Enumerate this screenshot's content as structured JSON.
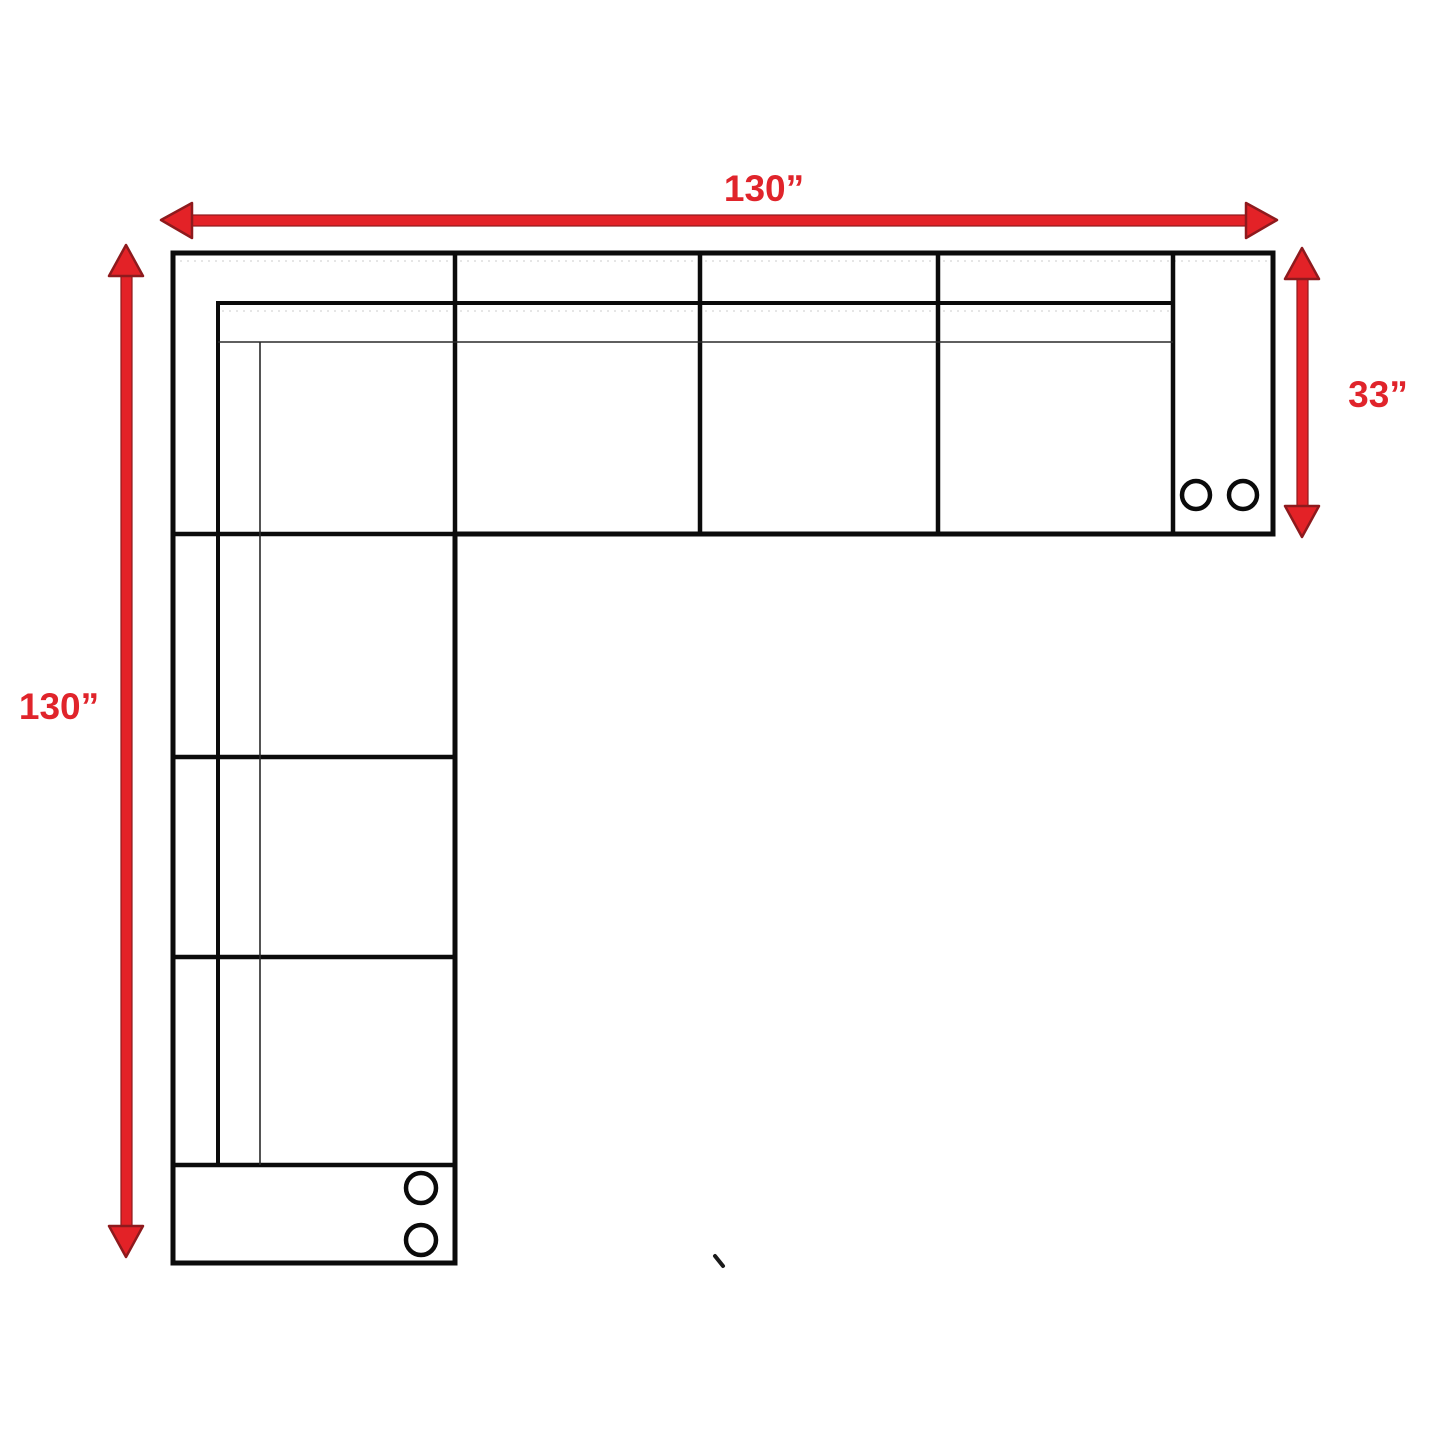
{
  "page": {
    "background": "#ffffff",
    "kind": "sectional-sofa-dimension-diagram"
  },
  "diagram": {
    "dimensions": {
      "top_width": {
        "label": "130”",
        "orientation": "horizontal",
        "edge": "top"
      },
      "left_height": {
        "label": "130”",
        "orientation": "vertical",
        "edge": "left"
      },
      "right_depth": {
        "label": "33”",
        "orientation": "vertical",
        "edge": "right"
      }
    },
    "colors": {
      "dimension_red": "#e32227",
      "arrowhead_dark_red": "#8e1a1d",
      "label_red": "#e0242b",
      "outline_black": "#0b0b0b",
      "faint_line_gray": "#d8d8d8"
    },
    "casters": {
      "right_arm_count": 2,
      "bottom_arm_count": 2
    }
  }
}
